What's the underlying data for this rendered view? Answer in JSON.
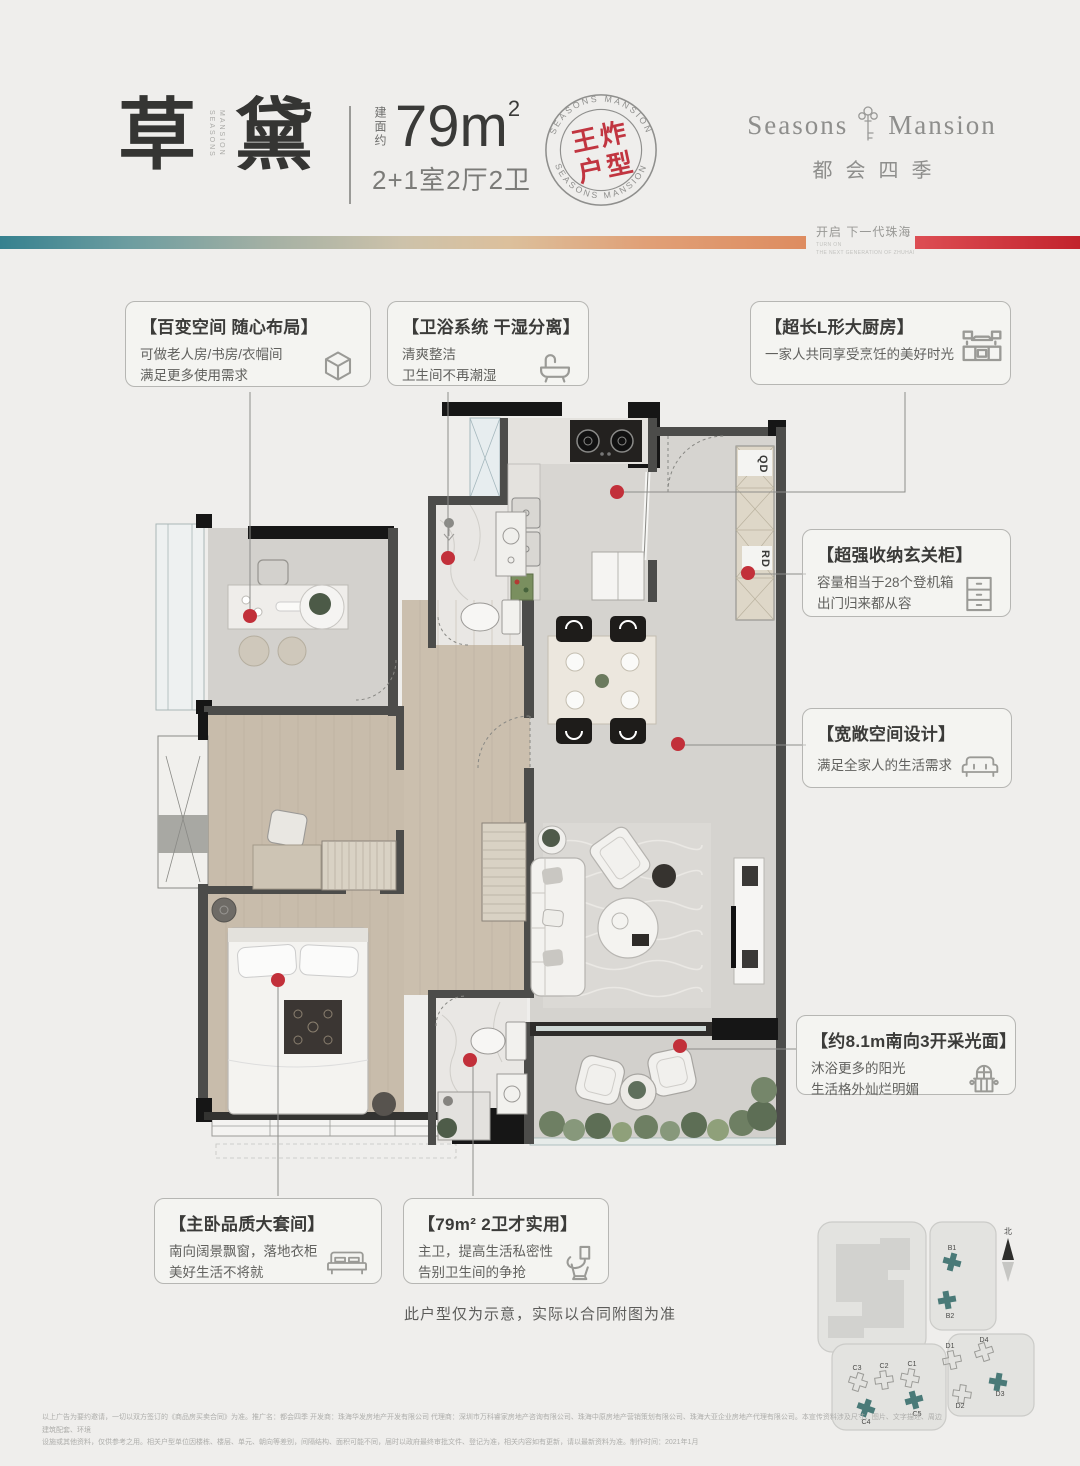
{
  "header": {
    "title_char1": "草",
    "title_char2": "黛",
    "title_side1": "SEASONS",
    "title_side2": "MANSION",
    "area_prefix": "建面约",
    "area_value": "79m",
    "area_sup": "2",
    "layout": "2+1室2厅2卫",
    "logo_en_left": "Seasons",
    "logo_en_right": "Mansion",
    "logo_cn": "都会四季",
    "tagline_cn": "开启 下一代珠海",
    "tagline_en1": "TURN ON",
    "tagline_en2": "THE NEXT GENERATION OF ZHUHAI"
  },
  "stamp": {
    "word1": "王炸",
    "word2": "户型",
    "ring": "SEASONS MANSION"
  },
  "callouts": {
    "flex": {
      "title": "【百变空间 随心布局】",
      "line1": "可做老人房/书房/衣帽间",
      "line2": "满足更多使用需求"
    },
    "wetdry": {
      "title": "【卫浴系统 干湿分离】",
      "line1": "清爽整洁",
      "line2": "卫生间不再潮湿"
    },
    "kitchen": {
      "title": "【超长L形大厨房】",
      "line1": "一家人共同享受烹饪的美好时光"
    },
    "foyer": {
      "title": "【超强收纳玄关柜】",
      "line1": "容量相当于28个登机箱",
      "line2": "出门归来都从容"
    },
    "space": {
      "title": "【宽敞空间设计】",
      "line1": "满足全家人的生活需求"
    },
    "daylight": {
      "title": "【约8.1m南向3开采光面】",
      "line1": "沐浴更多的阳光",
      "line2": "生活格外灿烂明媚"
    },
    "master": {
      "title": "【主卧品质大套间】",
      "line1": "南向阔景飘窗，落地衣柜",
      "line2": "美好生活不将就"
    },
    "bath2": {
      "title": "【79m² 2卫才实用】",
      "line1": "主卫，提高生活私密性",
      "line2": "告别卫生间的争抢"
    }
  },
  "floorplan": {
    "label_qd": "QD",
    "label_rd": "RD"
  },
  "note": "此户型仅为示意，实际以合同附图为准",
  "siteplan": {
    "north": "北",
    "labels": [
      "B1",
      "B2",
      "C1",
      "C2",
      "C3",
      "C4",
      "C5",
      "D1",
      "D2",
      "D3",
      "D4"
    ]
  },
  "disclaimer": {
    "line1": "以上广告为要约邀请，一切以双方签订的《商品房买卖合同》为准。推广名：都会四季 开发商：珠海华发房地产开发有限公司 代理商：深圳市万科睿家房地产咨询有限公司、珠海中原房地产营销策划有限公司、珠海大亚企业房地产代理有限公司。本宣传资料涉及尺寸、图片、文字描述、周边建筑配套、环境",
    "line2": "设施或其他资料，仅供参考之用。相关户型单位因楼栋、楼层、单元、朝向等差别，间隔结构、面积可能不同，届时以政府最终审批文件、登记为准，相关内容如有更新，请以最新资料为准。制作时间：2021年1月"
  }
}
